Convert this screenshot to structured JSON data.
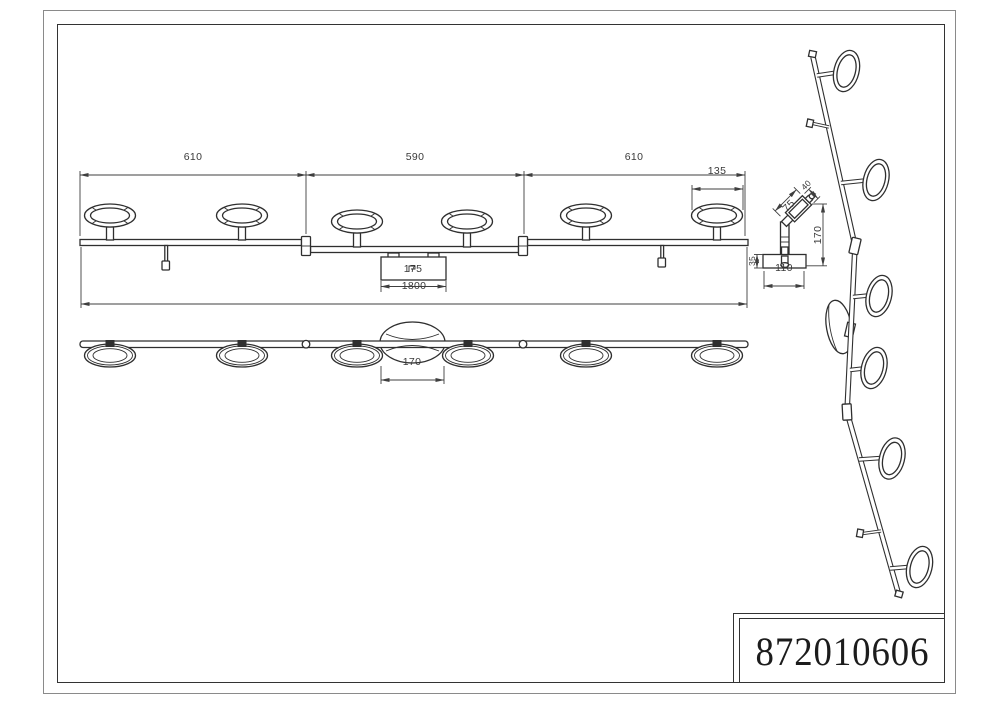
{
  "title_block": {
    "part_number": "872010606"
  },
  "top_view": {
    "segment_left_mm": "610",
    "segment_middle_mm": "590",
    "segment_right_mm": "610",
    "head_diameter_mm": "135",
    "canopy_width_mm": "175",
    "overall_length_mm": "1800"
  },
  "front_view": {
    "canopy_width_mm": "170"
  },
  "side_view": {
    "head_length_mm": "75",
    "head_depth_mm": "40",
    "height_mm": "170",
    "base_height_mm": "35",
    "base_width_mm": "110"
  },
  "colors": {
    "line": "#2f2f2f",
    "dimension": "#3f3f3f",
    "background": "#ffffff"
  }
}
